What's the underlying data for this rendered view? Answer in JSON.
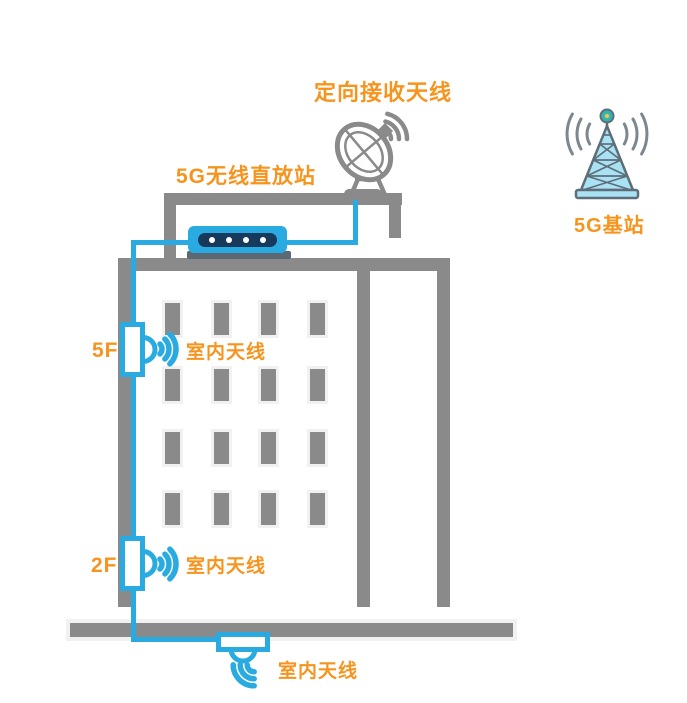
{
  "diagram": {
    "rooftop": {
      "dish_label": "定向接收天线",
      "repeater_label": "5G无线直放站"
    },
    "base_station": {
      "label": "5G基站"
    },
    "floors": [
      {
        "id": "5F",
        "antenna_label": "室内天线"
      },
      {
        "id": "2F",
        "antenna_label": "室内天线"
      }
    ],
    "ground_floor": {
      "antenna_label": "室内天线"
    }
  },
  "colors": {
    "accent_orange": "#F7941E",
    "cable_blue": "#29ABE2",
    "device_panel_navy": "#17395C",
    "building_gray": "#8A8A8A",
    "tower_fill_blue": "#A9E2F4",
    "tower_outline_slate": "#5E6E78",
    "tower_beacon_teal": "#2FB5B2"
  },
  "icons": {
    "dish": "satellite-dish-icon",
    "wifi": "wifi-waves-icon",
    "wall_antenna": "wall-antenna-icon",
    "ceiling_antenna": "ceiling-antenna-icon",
    "tower": "cell-tower-icon"
  }
}
